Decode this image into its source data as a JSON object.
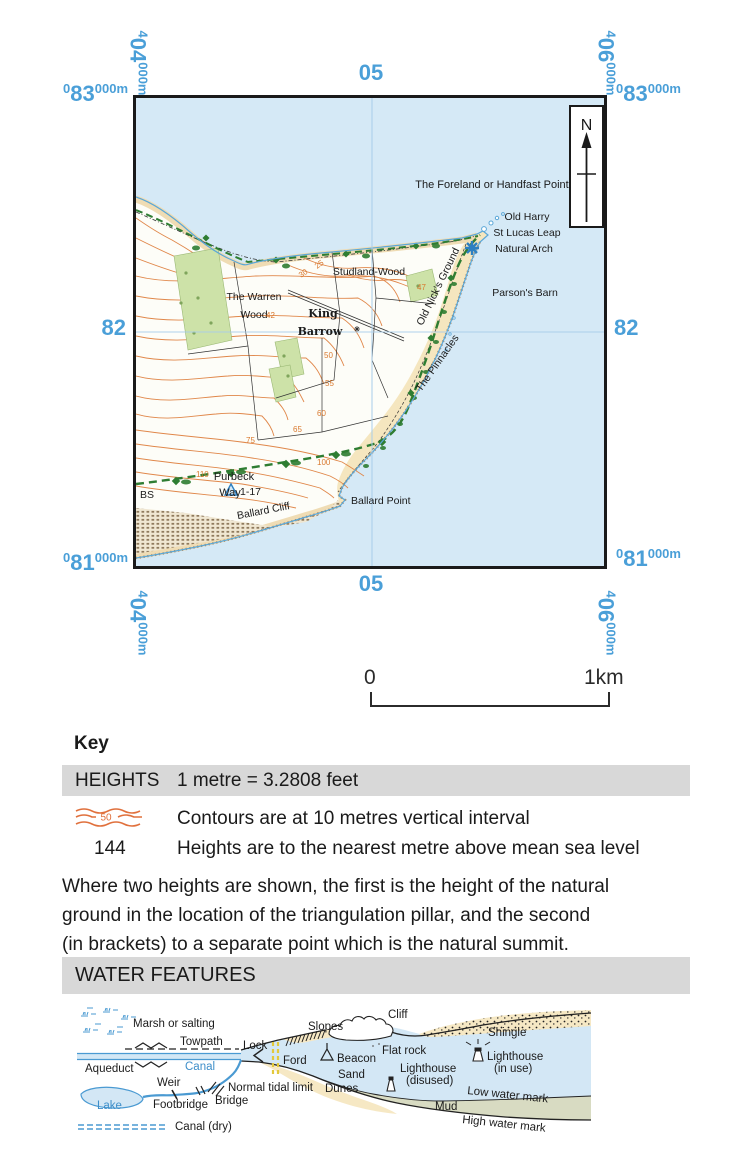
{
  "colors": {
    "grid_blue": "#4a9fd8",
    "sea": "#d5e9f6",
    "land": "#fdfdf8",
    "coastal_sand": "#f5e6bf",
    "contour_orange": "#e0874a",
    "wood_green": "#cde2a8",
    "path_green": "#2e7d32",
    "water_line_blue": "#4a9ad2",
    "water_label_blue": "#3d8ec9",
    "mud": "#d8dbc2",
    "key_bar_bg": "#d8d8d8",
    "frame_black": "#1a1a1a",
    "ford_yellow": "#e3c93c"
  },
  "grid": {
    "easting_left": {
      "sm1": "4",
      "lg": "04",
      "sm2": "000m"
    },
    "easting_mid": "05",
    "easting_right": {
      "sm1": "4",
      "lg": "06",
      "sm2": "000m"
    },
    "northing_top": {
      "sm1": "0",
      "lg": "83",
      "sm2": "000m"
    },
    "northing_mid": "82",
    "northing_bottom": {
      "sm1": "0",
      "lg": "81",
      "sm2": "000m"
    }
  },
  "map": {
    "north_label": "N",
    "labels": {
      "foreland": "The Foreland or Handfast Point",
      "old_harry": "Old Harry",
      "st_lucas_leap": "St Lucas Leap",
      "natural_arch": "Natural Arch",
      "parsons_barn": "Parson's Barn",
      "studland_wood": "Studland-Wood",
      "warren_wood_1": "The Warren",
      "warren_wood_2": "Wood",
      "king_barrow_1": "King",
      "king_barrow_2": "Barrow",
      "old_nicks_ground": "Old Nick's Ground",
      "the_pinnacles": "The Pinnacles",
      "purbeck_1": "Purbeck",
      "purbeck_2": "Way",
      "bs": "BS",
      "trig_height": "1-17",
      "ballard_cliff": "Ballard Cliff",
      "ballard_point": "Ballard Point"
    },
    "contours": {
      "c25": "25",
      "c30": "30",
      "c42": "42",
      "c47": "47",
      "c50": "50",
      "c55": "55",
      "c60": "60",
      "c65": "65",
      "c75": "75",
      "c100": "100",
      "c110": "110"
    }
  },
  "scalebar": {
    "zero": "0",
    "one_km": "1km"
  },
  "key": {
    "title": "Key",
    "heights_header": "HEIGHTS",
    "conversion": "1 metre = 3.2808 feet",
    "contour_sample": "50",
    "contour_text": "Contours are at 10 metres vertical interval",
    "height_sample": "144",
    "height_text": "Heights are to the nearest metre above mean sea level",
    "note_lines": [
      "Where two heights are shown, the first is the height of the natural",
      "ground in the location of the triangulation pillar, and the second",
      "(in brackets) to a separate point which is the natural summit."
    ],
    "water_header": "WATER FEATURES"
  },
  "water": {
    "labels": {
      "marsh": "Marsh or salting",
      "towpath": "Towpath",
      "lock": "Lock",
      "canal": "Canal",
      "aqueduct": "Aqueduct",
      "ford": "Ford",
      "weir": "Weir",
      "normal_tidal_limit": "Normal tidal limit",
      "lake": "Lake",
      "footbridge": "Footbridge",
      "bridge": "Bridge",
      "canal_dry": "Canal (dry)",
      "slopes": "Slopes",
      "cliff": "Cliff",
      "beacon": "Beacon",
      "flat_rock": "Flat rock",
      "sand": "Sand",
      "dunes": "Dunes",
      "lighthouse": "Lighthouse",
      "disused": "(disused)",
      "in_use": "(in use)",
      "shingle": "Shingle",
      "low_water_mark": "Low water mark",
      "mud": "Mud",
      "high_water_mark": "High water mark"
    }
  }
}
